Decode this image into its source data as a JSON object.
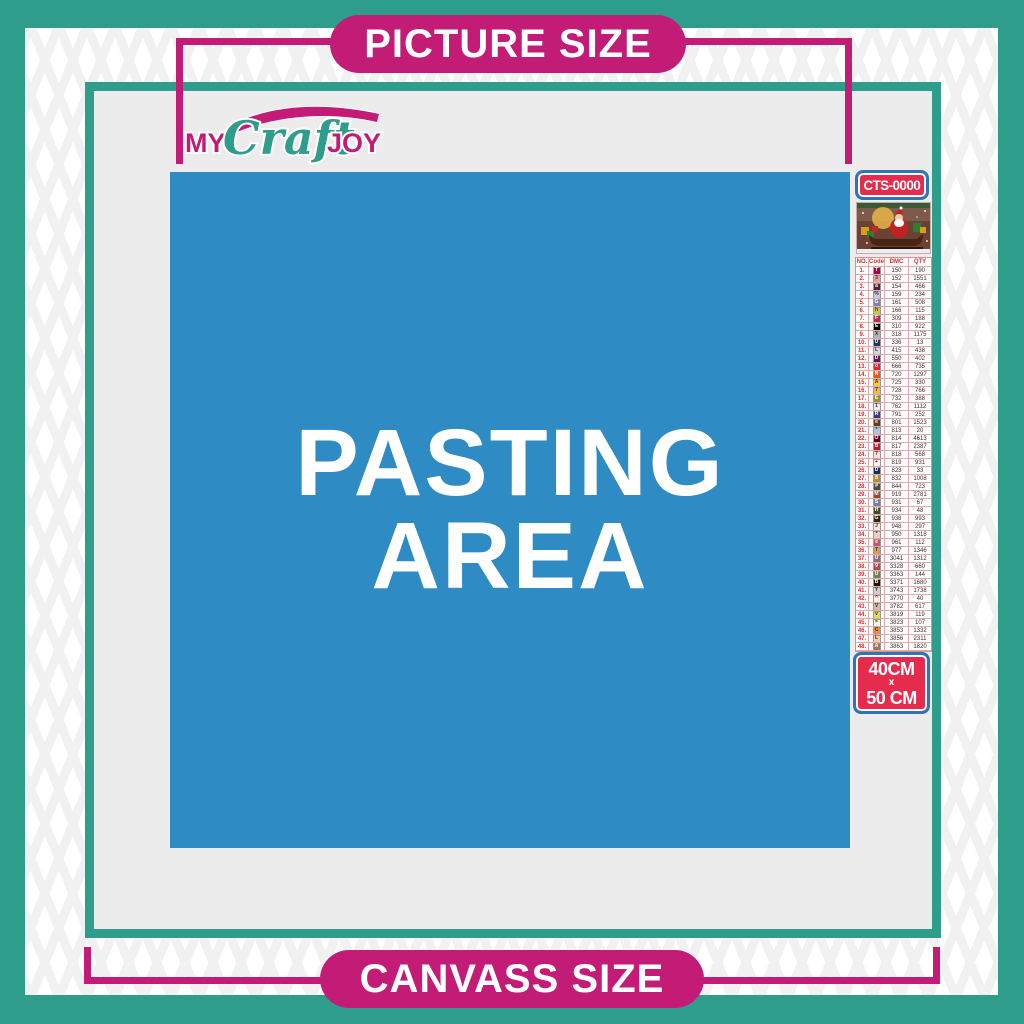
{
  "colors": {
    "teal": "#2F9D8C",
    "magenta": "#C21C77",
    "blue": "#2E8BC3",
    "red": "#E62C4D",
    "badge_border": "#2E74B6",
    "work_area_gray": "#ECECEC"
  },
  "banners": {
    "top": "PICTURE SIZE",
    "bottom": "CANVASS SIZE"
  },
  "logo": {
    "my": "MY",
    "craft": "Craft",
    "joy": "JOY"
  },
  "pasting_area": {
    "line1": "PASTING",
    "line2": "AREA"
  },
  "sidebar": {
    "sku": "CTS-0000",
    "thumbnail": "santa-claus-sleigh-christmas-scene",
    "size": {
      "width": "40CM",
      "sep": "x",
      "height": "50 CM"
    },
    "table": {
      "headers": [
        "NO.",
        "Code",
        "DMC",
        "QTY"
      ],
      "rows": [
        [
          "1.",
          "T",
          "#AB0249",
          "#ffffff",
          "150",
          "190"
        ],
        [
          "2.",
          "3",
          "#E0A49C",
          "#333333",
          "152",
          "1551"
        ],
        [
          "3.",
          "a",
          "#572433",
          "#ffffff",
          "154",
          "466"
        ],
        [
          "4.",
          "%",
          "#C6CCE0",
          "#333333",
          "159",
          "234"
        ],
        [
          "5.",
          "G",
          "#7C85A8",
          "#ffffff",
          "161",
          "508"
        ],
        [
          "6.",
          "h",
          "#C3C946",
          "#333333",
          "166",
          "115"
        ],
        [
          "7.",
          "F",
          "#BA2C50",
          "#ffffff",
          "309",
          "188"
        ],
        [
          "8.",
          "E",
          "#000000",
          "#ffffff",
          "310",
          "922"
        ],
        [
          "9.",
          "X",
          "#B2B2B4",
          "#333333",
          "318",
          "1175"
        ],
        [
          "10.",
          "U",
          "#24355F",
          "#ffffff",
          "336",
          "13"
        ],
        [
          "11.",
          "L",
          "#D6D6D8",
          "#333333",
          "415",
          "438"
        ],
        [
          "12.",
          "D",
          "#5B1A51",
          "#ffffff",
          "550",
          "402"
        ],
        [
          "13.",
          "o",
          "#E32636",
          "#ffffff",
          "666",
          "735"
        ],
        [
          "14.",
          "N",
          "#E5591F",
          "#ffffff",
          "720",
          "1297"
        ],
        [
          "15.",
          "A",
          "#FFC93C",
          "#333333",
          "725",
          "330"
        ],
        [
          "16.",
          "7",
          "#F0B84E",
          "#333333",
          "728",
          "766"
        ],
        [
          "17.",
          "E",
          "#9A9235",
          "#ffffff",
          "732",
          "388"
        ],
        [
          "18.",
          "1",
          "#ECECEE",
          "#333333",
          "762",
          "1112"
        ],
        [
          "19.",
          "R",
          "#39407E",
          "#ffffff",
          "791",
          "252"
        ],
        [
          "20.",
          "e",
          "#653A1E",
          "#ffffff",
          "801",
          "1523"
        ],
        [
          "21.",
          "*",
          "#A3C7E0",
          "#333333",
          "813",
          "20"
        ],
        [
          "22.",
          "O",
          "#700019",
          "#ffffff",
          "814",
          "4613"
        ],
        [
          "23.",
          "B",
          "#C0182C",
          "#ffffff",
          "817",
          "2387"
        ],
        [
          "24.",
          "7",
          "#FFDFD9",
          "#333333",
          "818",
          "568"
        ],
        [
          "25.",
          "+",
          "#FFEEEB",
          "#333333",
          "819",
          "931"
        ],
        [
          "26.",
          "D",
          "#1F2C56",
          "#ffffff",
          "823",
          "33"
        ],
        [
          "27.",
          "8",
          "#B58B2A",
          "#ffffff",
          "832",
          "1008"
        ],
        [
          "28.",
          "#",
          "#4A4A4A",
          "#ffffff",
          "844",
          "723"
        ],
        [
          "29.",
          "M",
          "#A5442A",
          "#ffffff",
          "919",
          "2781"
        ],
        [
          "30.",
          "S",
          "#6A859E",
          "#ffffff",
          "931",
          "67"
        ],
        [
          "31.",
          "H",
          "#404A21",
          "#ffffff",
          "934",
          "48"
        ],
        [
          "32.",
          "G",
          "#36220F",
          "#ffffff",
          "938",
          "993"
        ],
        [
          "33.",
          "J",
          "#FEE7DA",
          "#333333",
          "948",
          "297"
        ],
        [
          "34.",
          "*",
          "#EECFBC",
          "#333333",
          "950",
          "1318"
        ],
        [
          "35.",
          "e",
          "#C65571",
          "#ffffff",
          "961",
          "112"
        ],
        [
          "36.",
          "T",
          "#DC9C56",
          "#333333",
          "977",
          "1346"
        ],
        [
          "37.",
          "U",
          "#8E6C7E",
          "#ffffff",
          "3041",
          "1312"
        ],
        [
          "38.",
          "9",
          "#B54A4A",
          "#ffffff",
          "3328",
          "660"
        ],
        [
          "39.",
          "U",
          "#6F8352",
          "#ffffff",
          "3363",
          "144"
        ],
        [
          "40.",
          "B",
          "#241307",
          "#ffffff",
          "3371",
          "1680"
        ],
        [
          "41.",
          "Y",
          "#D7CBD3",
          "#333333",
          "3743",
          "1738"
        ],
        [
          "42.",
          "^",
          "#FFEEE3",
          "#333333",
          "3770",
          "40"
        ],
        [
          "43.",
          "V",
          "#D2BCA6",
          "#333333",
          "3782",
          "617"
        ],
        [
          "44.",
          "v",
          "#D8E04C",
          "#333333",
          "3819",
          "119"
        ],
        [
          "45.",
          "=",
          "#FFFDE3",
          "#333333",
          "3823",
          "107"
        ],
        [
          "46.",
          "C",
          "#EB8C3C",
          "#333333",
          "3853",
          "1332"
        ],
        [
          "47.",
          "L",
          "#F7CBA6",
          "#333333",
          "3856",
          "2311"
        ],
        [
          "48.",
          "A",
          "#9A7558",
          "#ffffff",
          "3863",
          "1820"
        ]
      ]
    }
  }
}
